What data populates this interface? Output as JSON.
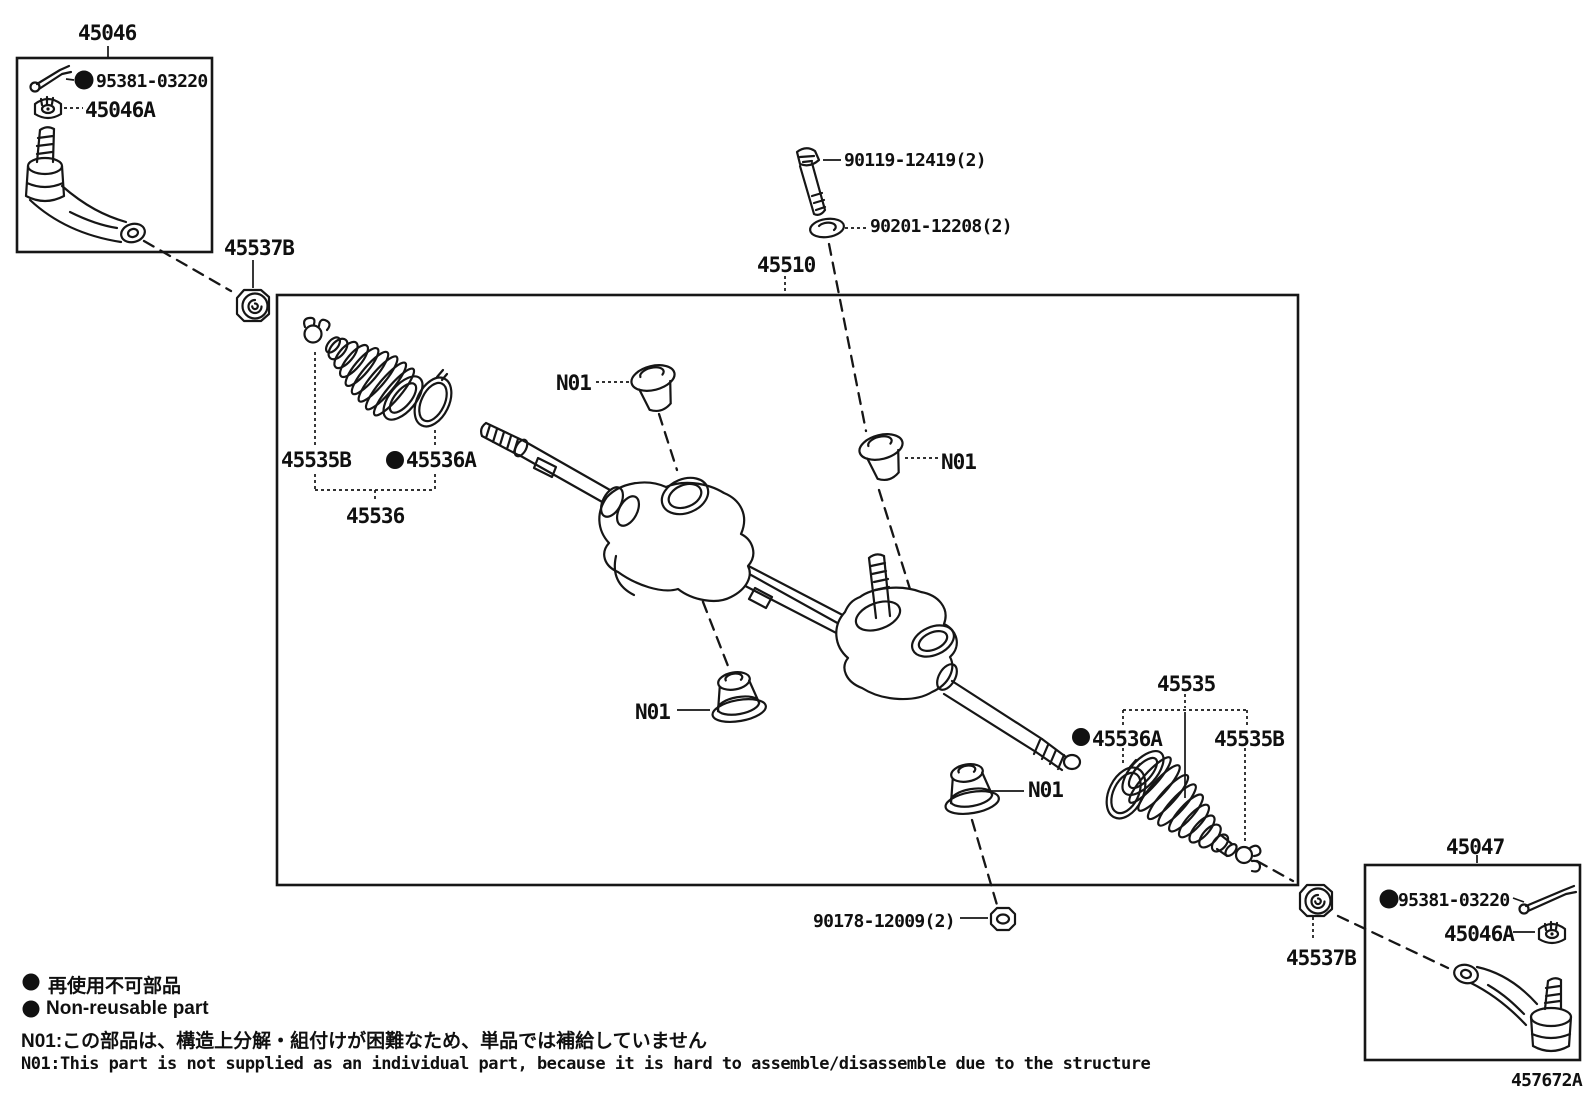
{
  "labels": {
    "assembly": "45510",
    "left_box": "45046",
    "right_box": "45047",
    "cotter_pin": "95381-03220",
    "castle_nut": "45046A",
    "lock_nut": "45537B",
    "bolt": "90119-12419(2)",
    "washer": "90201-12208(2)",
    "nut": "90178-12009(2)",
    "boot_kit_right": "45535",
    "boot_kit_left": "45536",
    "clamp_small": "45535B",
    "clamp_ring": "45536A",
    "grommet": "N01",
    "drawing_code": "457672A"
  },
  "legend": {
    "nonreusable_jp": "再使用不可部品",
    "nonreusable_en": "Non-reusable part",
    "note_jp": "N01:この部品は、構造上分解・組付けが困難なため、単品では補給していません",
    "note_en": "N01:This part is not supplied as an individual part, because it is hard to assemble/disassemble due to the structure"
  },
  "colors": {
    "ink": "#161616",
    "paper": "#ffffff"
  }
}
